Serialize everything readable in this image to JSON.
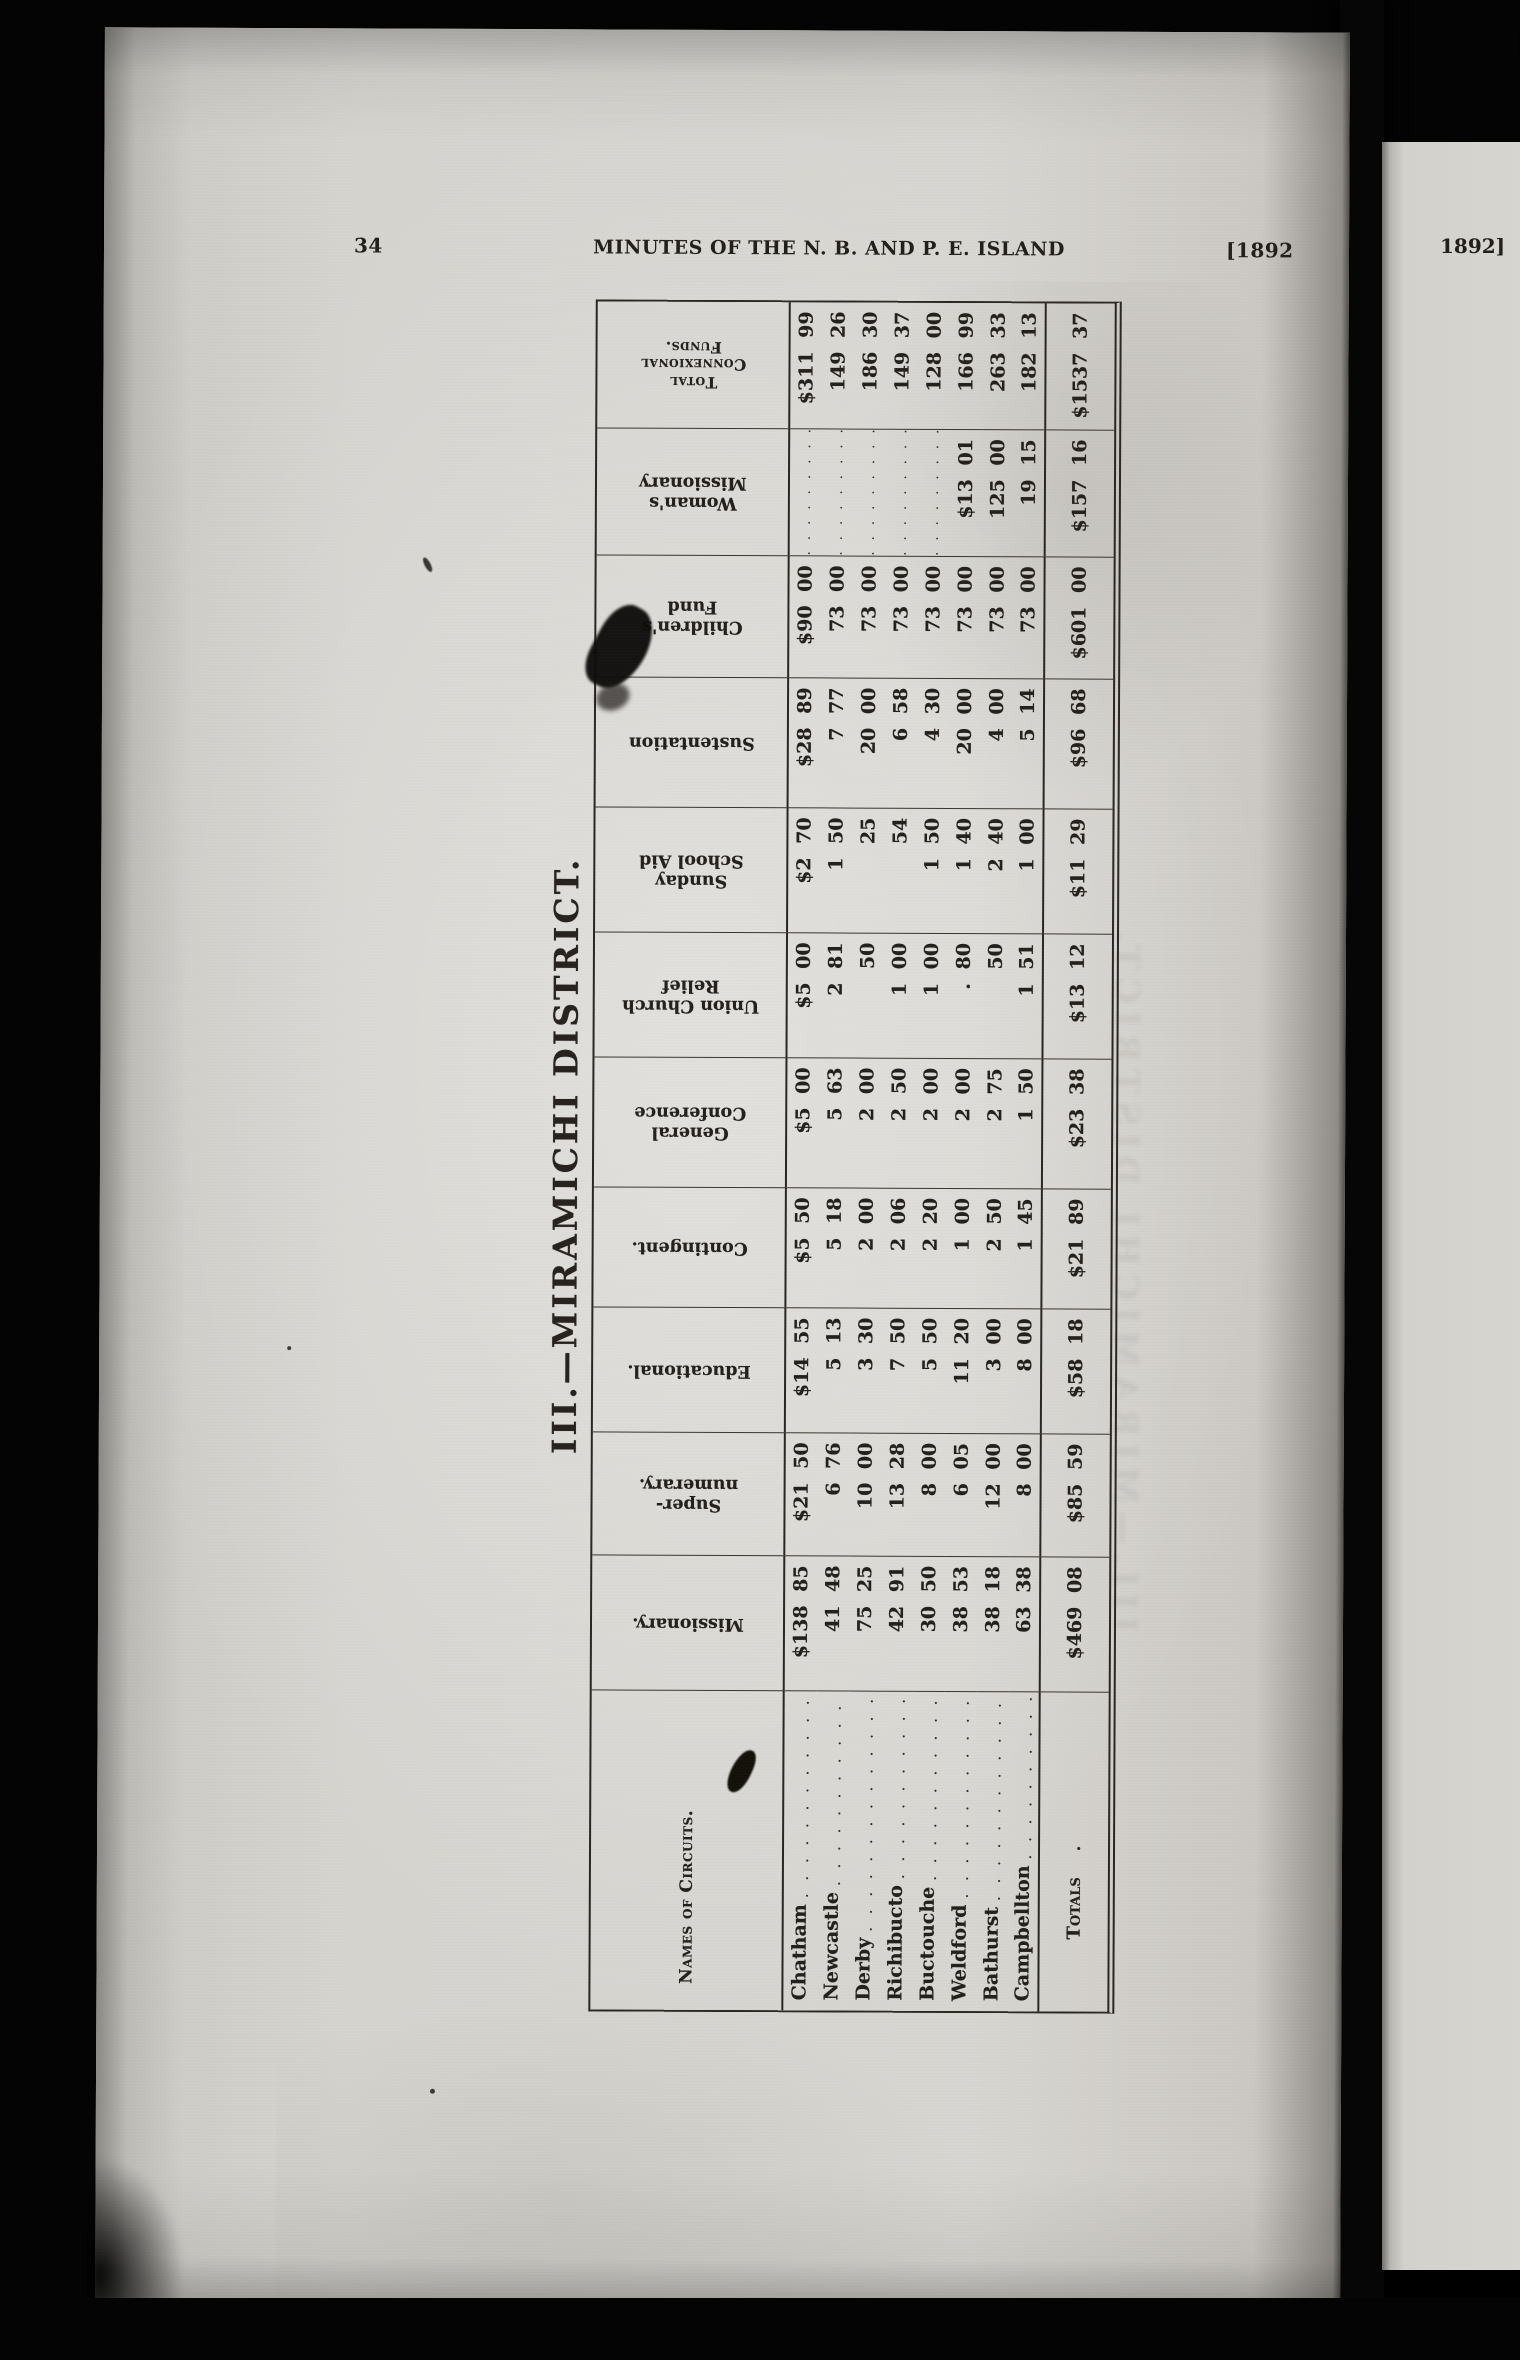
{
  "page": {
    "page_number": "34",
    "running_header": "MINUTES OF THE N. B. AND P. E. ISLAND",
    "year_left": "[1892",
    "year_right_page": "1892]"
  },
  "table": {
    "title": "III.—MIRAMICHI DISTRICT.",
    "columns": [
      {
        "key": "circuits",
        "label": "Names of Circuits.",
        "orientation": "horizontal"
      },
      {
        "key": "missionary",
        "label_lines": [
          "Missionary."
        ]
      },
      {
        "key": "supernumerary",
        "label_lines": [
          "Super-",
          "numerary."
        ]
      },
      {
        "key": "educational",
        "label_lines": [
          "Educational."
        ]
      },
      {
        "key": "contingent",
        "label_lines": [
          "Contingent."
        ]
      },
      {
        "key": "general-conference",
        "label_lines": [
          "General",
          "Conference"
        ]
      },
      {
        "key": "union-church-relief",
        "label_lines": [
          "Union Church",
          "Relief"
        ]
      },
      {
        "key": "sunday-school-aid",
        "label_lines": [
          "Sunday",
          "School Aid"
        ]
      },
      {
        "key": "sustentation",
        "label_lines": [
          "Sustentation"
        ]
      },
      {
        "key": "childrens-fund",
        "label_lines": [
          "Children's",
          "Fund"
        ]
      },
      {
        "key": "womans-missionary",
        "label_lines": [
          "Woman's",
          "Missionary"
        ]
      },
      {
        "key": "total-connexional-funds",
        "label_lines": [
          "Total",
          "Connexional",
          "Funds."
        ],
        "smallcaps": true
      }
    ],
    "rows": [
      {
        "circuit": "Chatham",
        "values": [
          "$138 85",
          "$21 50",
          "$14 55",
          "$5 50",
          "$5 00",
          "$5 00",
          "$2 70",
          "$28 89",
          "$90 00",
          "",
          "$311 99"
        ]
      },
      {
        "circuit": "Newcastle",
        "values": [
          "41 48",
          "6 76",
          "5 13",
          "5 18",
          "5 63",
          "2 81",
          "1 50",
          "7 77",
          "73 00",
          "",
          "149 26"
        ]
      },
      {
        "circuit": "Derby",
        "values": [
          "75 25",
          "10 00",
          "3 30",
          "2 00",
          "2 00",
          "50",
          "25",
          "20 00",
          "73 00",
          "",
          "186 30"
        ]
      },
      {
        "circuit": "Richibucto",
        "values": [
          "42 91",
          "13 28",
          "7 50",
          "2 06",
          "2 50",
          "1 00",
          "54",
          "6 58",
          "73 00",
          "",
          "149 37"
        ]
      },
      {
        "circuit": "Buctouche",
        "values": [
          "30 50",
          "8 00",
          "5 50",
          "2 20",
          "2 00",
          "1 00",
          "1 50",
          "4 30",
          "73 00",
          "",
          "128 00"
        ]
      },
      {
        "circuit": "Weldford",
        "values": [
          "38 53",
          "6 05",
          "11 20",
          "1 00",
          "2 00",
          ". 80",
          "1 40",
          "20 00",
          "73 00",
          "$13 01",
          "166 99"
        ]
      },
      {
        "circuit": "Bathurst",
        "values": [
          "38 18",
          "12 00",
          "3 00",
          "2 50",
          "2 75",
          "50",
          "2 40",
          "4 00",
          "73 00",
          "125 00",
          "263 33"
        ]
      },
      {
        "circuit": "Campbellton",
        "values": [
          "63 38",
          "8 00",
          "8 00",
          "1 45",
          "1 50",
          "1 51",
          "1 00",
          "5 14",
          "73 00",
          "19 15",
          "182 13"
        ]
      }
    ],
    "totals": {
      "label": "Totals",
      "values": [
        "$469 08",
        "$85 59",
        "$58 18",
        "$21 89",
        "$23 38",
        "$13 12",
        "$11 29",
        "$96 68",
        "$601 00",
        "$157 16",
        "$1537 37"
      ]
    }
  }
}
